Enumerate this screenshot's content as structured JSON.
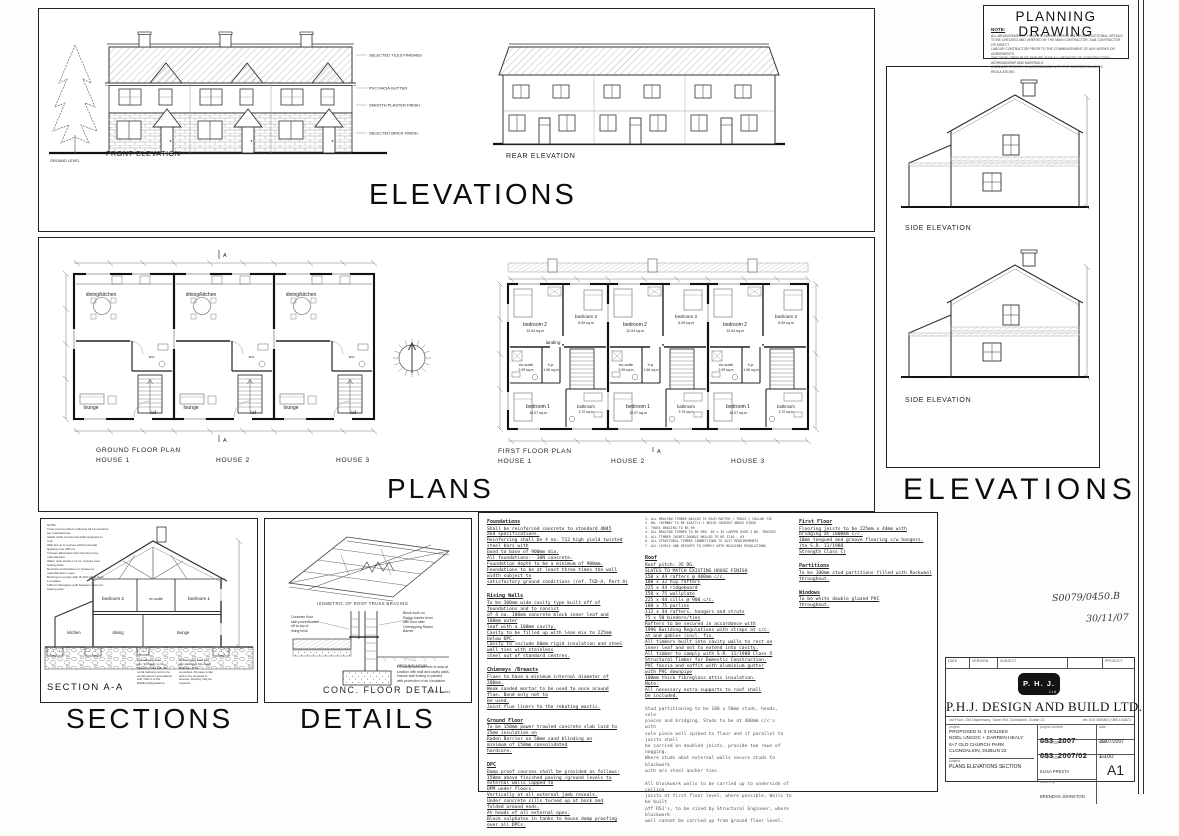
{
  "planning_box": {
    "title": "PLANNING DRAWING",
    "note_heading": "NOTE:",
    "note_lines": "ALL MEASUREMENTS, HEIGHTS, AREAS, LEVELS AND CONSTRUCTIONAL DETAILS\nTO BE CHECKED AND VERIFIED BY THE MAIN CONTRACTOR, SUB CONTRACTOR OR DIRECT\nLABOUR CONTRACTOR PRIOR TO THE COMMENCEMENT OF ANY WORKS OR AGREEMENTS.\nTHE DEVELOPER MUST ENSURE THAT ALL METHODS OF CONSTRUCTION, WORKMANSHIP AND MATERIALS\nUSED ARE STRICTLY IN ACCORDANCE WITH THE CURRENT BUILDING REGULATIONS."
  },
  "elevations": {
    "title": "ELEVATIONS",
    "front_label": "FRONT ELEVATION",
    "rear_label": "REAR ELEVATION",
    "ground_level": "GROUND LEVEL",
    "callouts": [
      "SELECTED TILES FINISHES",
      "PVC FACIA GUTTER",
      "SMOOTH PLASTER FINISH",
      "SELECTED BRICK FINISH"
    ]
  },
  "side": {
    "title": "ELEVATIONS",
    "label": "SIDE ELEVATION"
  },
  "plans": {
    "title": "PLANS",
    "section_marker": "A",
    "ground": {
      "caption": "GROUND FLOOR PLAN",
      "house1": "HOUSE 1",
      "house2": "HOUSE 2",
      "house3": "HOUSE 3",
      "rooms": {
        "dining_kitchen": "dining/kitchen",
        "wc": "w.c.",
        "lounge": "lounge",
        "hall": "hall"
      }
    },
    "first": {
      "caption": "FIRST FLOOR PLAN",
      "house1": "HOUSE 1",
      "house2": "HOUSE 2",
      "house3": "HOUSE 3",
      "rooms": {
        "bedroom2": "bedroom 2",
        "bedroom2_area": "12.04 sq.m",
        "bedroom3": "bedroom 3",
        "bedroom3_area": "5.09 sq.m",
        "landing": "landing",
        "ensuite": "en-suite",
        "ensuite_area": "2.09 sq.m",
        "hp": "h.p.",
        "hp_area": "1.56 sq.m",
        "bedroom1": "bedroom 1",
        "bedroom1_area": "10.07 sq.m",
        "bathroom": "bathroom",
        "bathroom_area": "3.70 sq.m"
      }
    }
  },
  "sections": {
    "title": "SECTIONS",
    "label": "SECTION A-A",
    "rooms": {
      "bedroom2": "bedroom 2",
      "ensuite": "en-suite",
      "bedroom1": "bedroom 1",
      "kitchen": "kitchen",
      "dining": "dining",
      "lounge": "lounge"
    },
    "notes_top": "NOTE:\nTruss roof members nailed at all connections\nper manufacturer.\nGable walls of external walls strapped to\nroof.\nWall ties at 4 courses with horizontal\nspacing max 450 c/c.\nTrusses fabricated and sized by truss\nmanufacturer.\nWater tank stand on 2 no. trusses over\nceiling joists.\nRoof felt and battens on trusses to\nmanufacturer's spec.\nBracing to comply with IS 193 when fixed\nin position.\n100mm fibreglass quilt between and over\nceiling joists.",
    "notes_bottom_left": "Foundations to be\nmin. 900 deep to be\nagreed on site with the\nLocal Authority and to be\nconstructed in accordance\nwith TGD A of the\nBuilding Regulations.",
    "notes_bottom_right": "Where pipes pass thro'\nfoundations a Structural\nEngineer to be\nconsulted. All pipes under\nslab to be encased in\nsleeves. Ducting may be\nrequired."
  },
  "details": {
    "title": "DETAILS",
    "iso_caption": "ISOMETRIC OF ROOF TRUSS BRACING",
    "detail_caption": "CONC. FLOOR DETAIL",
    "detail_scale": "(not to scale)",
    "ann_left": "Concrete floor\nslab powerfloated\noff to top of\nrising brick",
    "ann_right": "Block work on\nRadon barrier level\nwith floor slab.\nOverlapping Radon\nBarrier",
    "ann_ground": "GROUND LEVEL",
    "ann_bottom": "Fill cavity with lean mix to seal at\njunction with wall and cavity walls,\nensure wall footing is pointed\nwith protection of air circulation"
  },
  "specs": {
    "col1": [
      {
        "heading": "Foundations",
        "body": "Shall be reinforced concrete to standard 4N45\nand specifications.\nReinforcing shall be 4 no. T12 high yield twisted\nsteel bars with\nbond to base of 900mm dia.\nAll foundations:- 30N concrete.\nFoundation depth to be a minimum of 900mm.\nFoundations to be at least three times the wall\nwidth subject to\nsatisfactory ground conditions (ref. TGD-A, Part A)"
      },
      {
        "heading": "Rising Walls",
        "body": "To be 300mm wide cavity type built off of\nfoundations and to consist\nof 4 no. 100mm concrete block inner leaf and\n100mm outer\nleaf with a 100mm cavity.\nCavity to be filled up with lean mix to 225mm\nbelow DPC.\nCavity to include 60mm rigid insulation and steel\nwall ties with stainless\nsteel out of standard centres."
      },
      {
        "heading": "Chimneys /Breasts",
        "body": "Flues to have a minimum internal diameter of\n200mm.\nWeak sanded mortar to be used to once around\nflue. Bond only not to\nbe used.\nJoint flue liners to the rebating mastic."
      },
      {
        "heading": "Ground Floor",
        "body": "To be 150mm power trowled concrete slab laid to\n25mm insulation on\nRadon Barrier on 50mm sand blinding on\nminimum of 150mm consolidated\nhardcore."
      },
      {
        "heading": "DPC",
        "body": "Damp proof courses shall be provided as follows:\n150mm above finished paving /ground levels to\nexternal walls lapped to\nDPM under floors.\nVertically at all external jamb reveals.\nUnder concrete cills turned up at back and\nfolded around ends.\nAt heads of all external opes.\nBlock sulphates in tanks to house damp proofing\nover all DPCs."
      }
    ],
    "col2_note": {
      "heading": "NOTE",
      "body": "1. ALL BRACING TIMBER NAILED TO EACH RAFTER / TRUSS / COLLAR TIE\n2. NO. CHIMNEY TO BE EXACTLY 2 BRICK COURSES ABOVE RIDGE\n3. TRUSS BRACING TO BS 99\n4. ALL BRACING TIMBER TO BE MIN. 89 x 35 LAPPED OVER 2 NO. TRUSSES\n5. ALL TIMBER JOINTS DOUBLE NAILED TO BS 1210 - 63\n6. ALL STRUCTURAL TIMBER CONNECTIONS TO SUIT REQUIREMENTS\n7. ALL LEVELS AND HEIGHTS TO COMPLY WITH BUILDING REGULATIONS"
    },
    "col2": [
      {
        "heading": "Roof",
        "body": "Roof pitch: 35 DG.\nSLATES TO MATCH EXISTING HOUSE FINISH\n150 x 44 rafters @ 400mm c/c.\n100 x 32 hip rafters\n225 x 44 ridgeboard\n150 x 75 wallplate\n225 x 44 cills @ 900 c/c.\n100 x 75 purlins\n112 x 44 rafters, hangers and struts\n75 x 50 binders/ties\nRafters to be secured in accordance with\n1996 Building Regulations with straps at c/c.\nat and gables (incl. fix.\nAll timbers built into cavity walls to rest on\ninner leaf and not to extend into cavity.\nAll timber to comply with S.R. 11/1988 Class 5\nStructural Timber for Domestic Construction.\nPVC fascia and soffit with aluminium gutter\nwith PVC downpipe\n100mm thick fibreglass attic insulation.\nNote:\nAll necessary extra supports to roof shall\nbe included."
      },
      {
        "heading": "",
        "body": "Stud partitioning to be 100 x 50mm studs, heads,\nsole\npieces and bridging. Studs to be at 400mm c/c's\nwith\nsole piece well spiked to floor and if parallel to\njoists shall\nbe carried on doubled joists, provide two rows of\nnogging.\nWhere studs abut external walls secure studs to\nblockwork\nwith m/s steel anchor ties."
      },
      {
        "heading": "",
        "body": "All blockwork walls to be carried up to underside of\nceiling\njoists at first floor level, where possible. Walls to\nbe built\noff RSJ's, to be sized by Structural Engineer, where\nblockwork\nwall cannot be carried up from ground floor level."
      }
    ],
    "col3": [
      {
        "heading": "First Floor",
        "body": "Flooring joists to be 225mm x 44mm with\nbridging at 1800mm c/c.\n18mm tongued and groove flooring c/w hangers.\n(to S.R. 11/1988\nStrength Class C)"
      },
      {
        "heading": "Partitions",
        "body": "To be 100mm stud partitions filled with Rockwool\nthroughout."
      },
      {
        "heading": "Windows",
        "body": "To be white double glazed PVC\nthroughout."
      }
    ]
  },
  "title_block": {
    "rev_date": "DATE",
    "rev_version": "VERSION",
    "rev_subject": "SUBJECT",
    "rev_product": "PRODUCT",
    "logo_text": "P. H. J.",
    "logo_sub": "Ltd",
    "company": "P.H.J. DESIGN AND BUILD LTD.",
    "address": "1st Floor, Old Dispensary, Tower Rd, Clondalkin, Dublin 22",
    "phone": "tel: 015 400063 | 085 103871",
    "labels": {
      "project": "project",
      "project_number": "project number",
      "date": "date",
      "drawing_number": "drawing number",
      "scale": "scale",
      "subject": "subject",
      "designed_by": "designed by",
      "drawn_by": "drawn by",
      "size": "size"
    },
    "project_lines": "PROPOSED N. 3 HOUSES\nNOEL UNGOC + DARREN HEALY\n6+7 OLD CHURCH PARK\nCLONDALKIN, DUBLIN 22",
    "project_number": "053_2007",
    "date": "30/07/2007",
    "drawing_number": "053_2007/02",
    "scale": "1:100",
    "subject": "PLANS ELEVATIONS SECTION",
    "designed_by": "ELISA PRESTA",
    "drawn_by": "BRENDAN JOHNSTON",
    "size": "A1"
  },
  "handwritten": {
    "line1": "S0079/0450.B",
    "line2": "30/11/07"
  },
  "colors": {
    "ink": "#1a1a1a",
    "logo_bg": "#131313",
    "paper": "#ffffff"
  }
}
